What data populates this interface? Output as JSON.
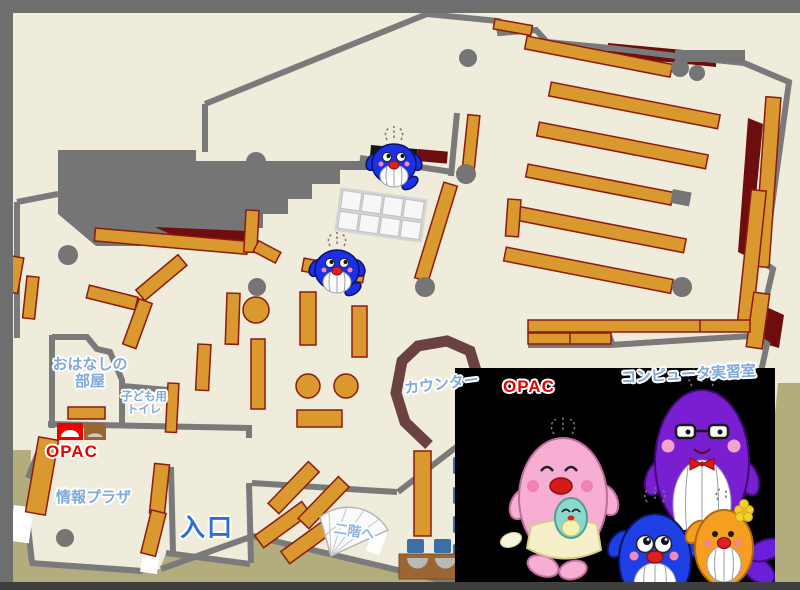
{
  "map": {
    "labels": {
      "story_room_line1": "おはなしの",
      "story_room_line2": "部屋",
      "kids_toilet_line1": "子ども用",
      "kids_toilet_line2": "トイレ",
      "opac_left": "OPAC",
      "opac_right": "OPAC",
      "info_plaza": "情報プラザ",
      "entrance": "入口",
      "counter": "カウンター",
      "computer_room": "コンピュータ実習室",
      "second_floor": "二階へ"
    },
    "icons": {
      "whale_mascot": "blue-whale-mascot",
      "mascot_family": "whale-family-illustration",
      "stairs": "spiral-stairs",
      "opac_terminal": "opac-terminal"
    },
    "colors": {
      "floor": "#EFECDC",
      "outside": "#B3AC7C",
      "wall": "#7A7A7A",
      "frame": "#6E6E6E",
      "bottom_bar": "#3F3F3F",
      "shelf": "#D9992E",
      "shelf_border": "#8C1A0E",
      "dark_red": "#6E0D0D",
      "counter_brown": "#6B4141",
      "table_brown": "#9A6633",
      "chair_blue": "#3A6FA7",
      "label_blue": "#7FA9DC",
      "entrance_blue": "#2E6FD6",
      "opac_red": "#E60000"
    }
  }
}
